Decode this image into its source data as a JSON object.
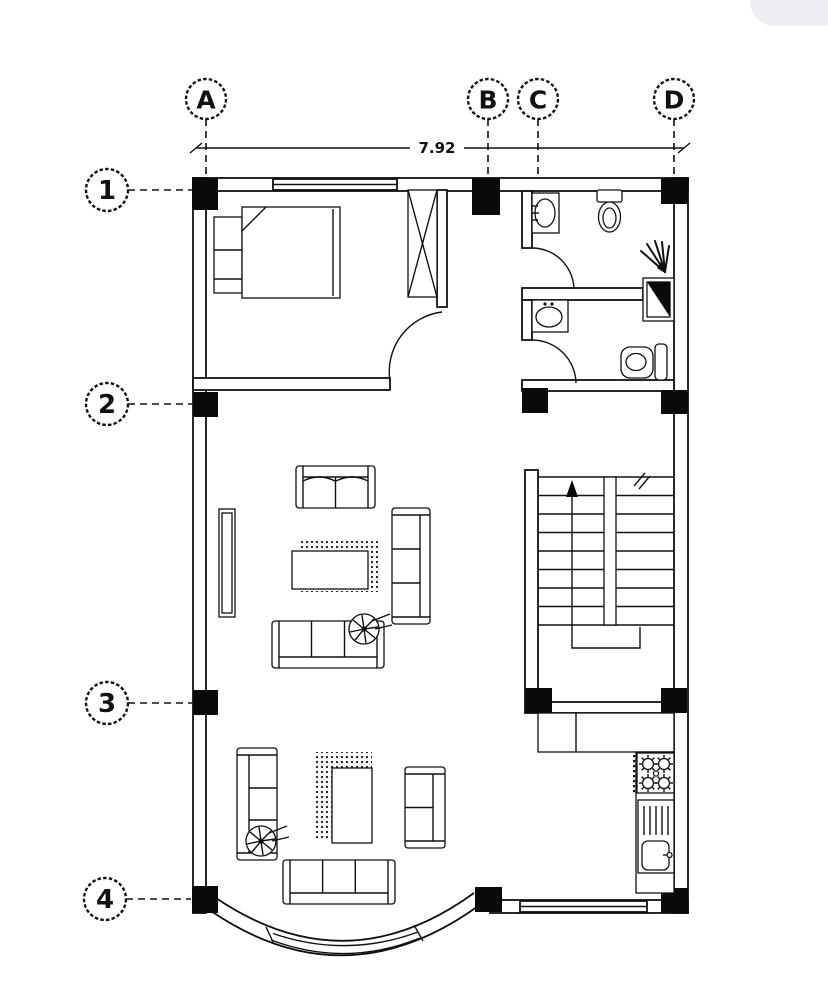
{
  "plan": {
    "dimension_label": "7.92",
    "grid_top": [
      {
        "label": "A"
      },
      {
        "label": "B"
      },
      {
        "label": "C"
      },
      {
        "label": "D"
      }
    ],
    "grid_left": [
      {
        "label": "1"
      },
      {
        "label": "2"
      },
      {
        "label": "3"
      },
      {
        "label": "4"
      }
    ],
    "colors": {
      "line": "#111111",
      "column_fill": "#0a0a0a",
      "pill": "#edeff2",
      "paper": "#ffffff"
    },
    "fixtures": {
      "bedroom": [
        "bed",
        "headboard-shelf",
        "wardrobe",
        "door-swing"
      ],
      "bathroom_top": [
        "wash-basin",
        "toilet",
        "shower-tray",
        "shower-spray",
        "door-swing"
      ],
      "bathroom_bottom": [
        "wash-basin",
        "toilet",
        "door-swing"
      ],
      "living_area": [
        "two-seat-sofa",
        "three-seat-sofa",
        "coffee-table",
        "rug",
        "tv-console",
        "plant"
      ],
      "lounge_area": [
        "three-seat-sofa",
        "two-seat-sofa",
        "coffee-table",
        "rug",
        "plant"
      ],
      "kitchen": [
        "counter",
        "gas-stove",
        "sink-drainboard"
      ],
      "stairs": [
        "treads",
        "up-arrow",
        "center-stringer",
        "break-mark"
      ],
      "facade": [
        "bow-window",
        "top-window",
        "bottom-window"
      ]
    }
  }
}
